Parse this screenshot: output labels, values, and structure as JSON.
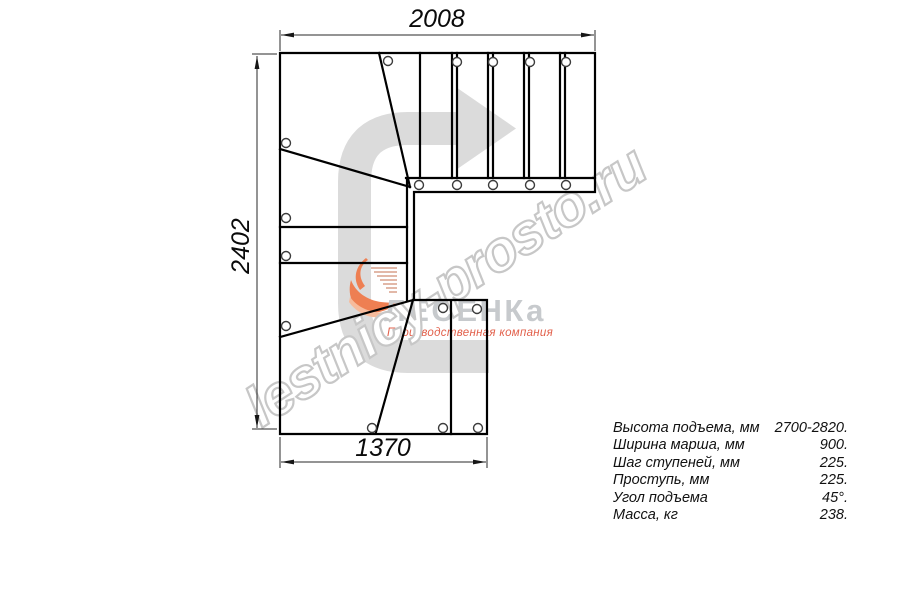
{
  "dimensions": {
    "top": "2008",
    "left": "2402",
    "bottom": "1370"
  },
  "specs": {
    "rows": [
      {
        "label": "Высота подъема, мм",
        "value": "2700-2820."
      },
      {
        "label": "Ширина марша, мм",
        "value": "900."
      },
      {
        "label": "Шаг ступеней, мм",
        "value": "225."
      },
      {
        "label": "Проступь, мм",
        "value": "225."
      },
      {
        "label": "Угол подъема",
        "value": "45°."
      },
      {
        "label": "Масса, кг",
        "value": "238."
      }
    ]
  },
  "watermark": {
    "text": "lestnicy-prosto.ru",
    "color": "#c7c7c7"
  },
  "logo": {
    "name": "ЛЕСЕНКа",
    "tagline": "Производственная компания",
    "name_color": "#c7cacd",
    "tagline_color": "#e2604b",
    "flame_color": "#ee7f52",
    "flame_light": "#f6bb9c",
    "dash_color": "#d8a18b"
  },
  "arrow": {
    "color": "#dbdbdb"
  },
  "drawing": {
    "line_color": "#000000",
    "hole_stroke": "#3c3c3c",
    "dim_color": "#2a2a2a"
  }
}
